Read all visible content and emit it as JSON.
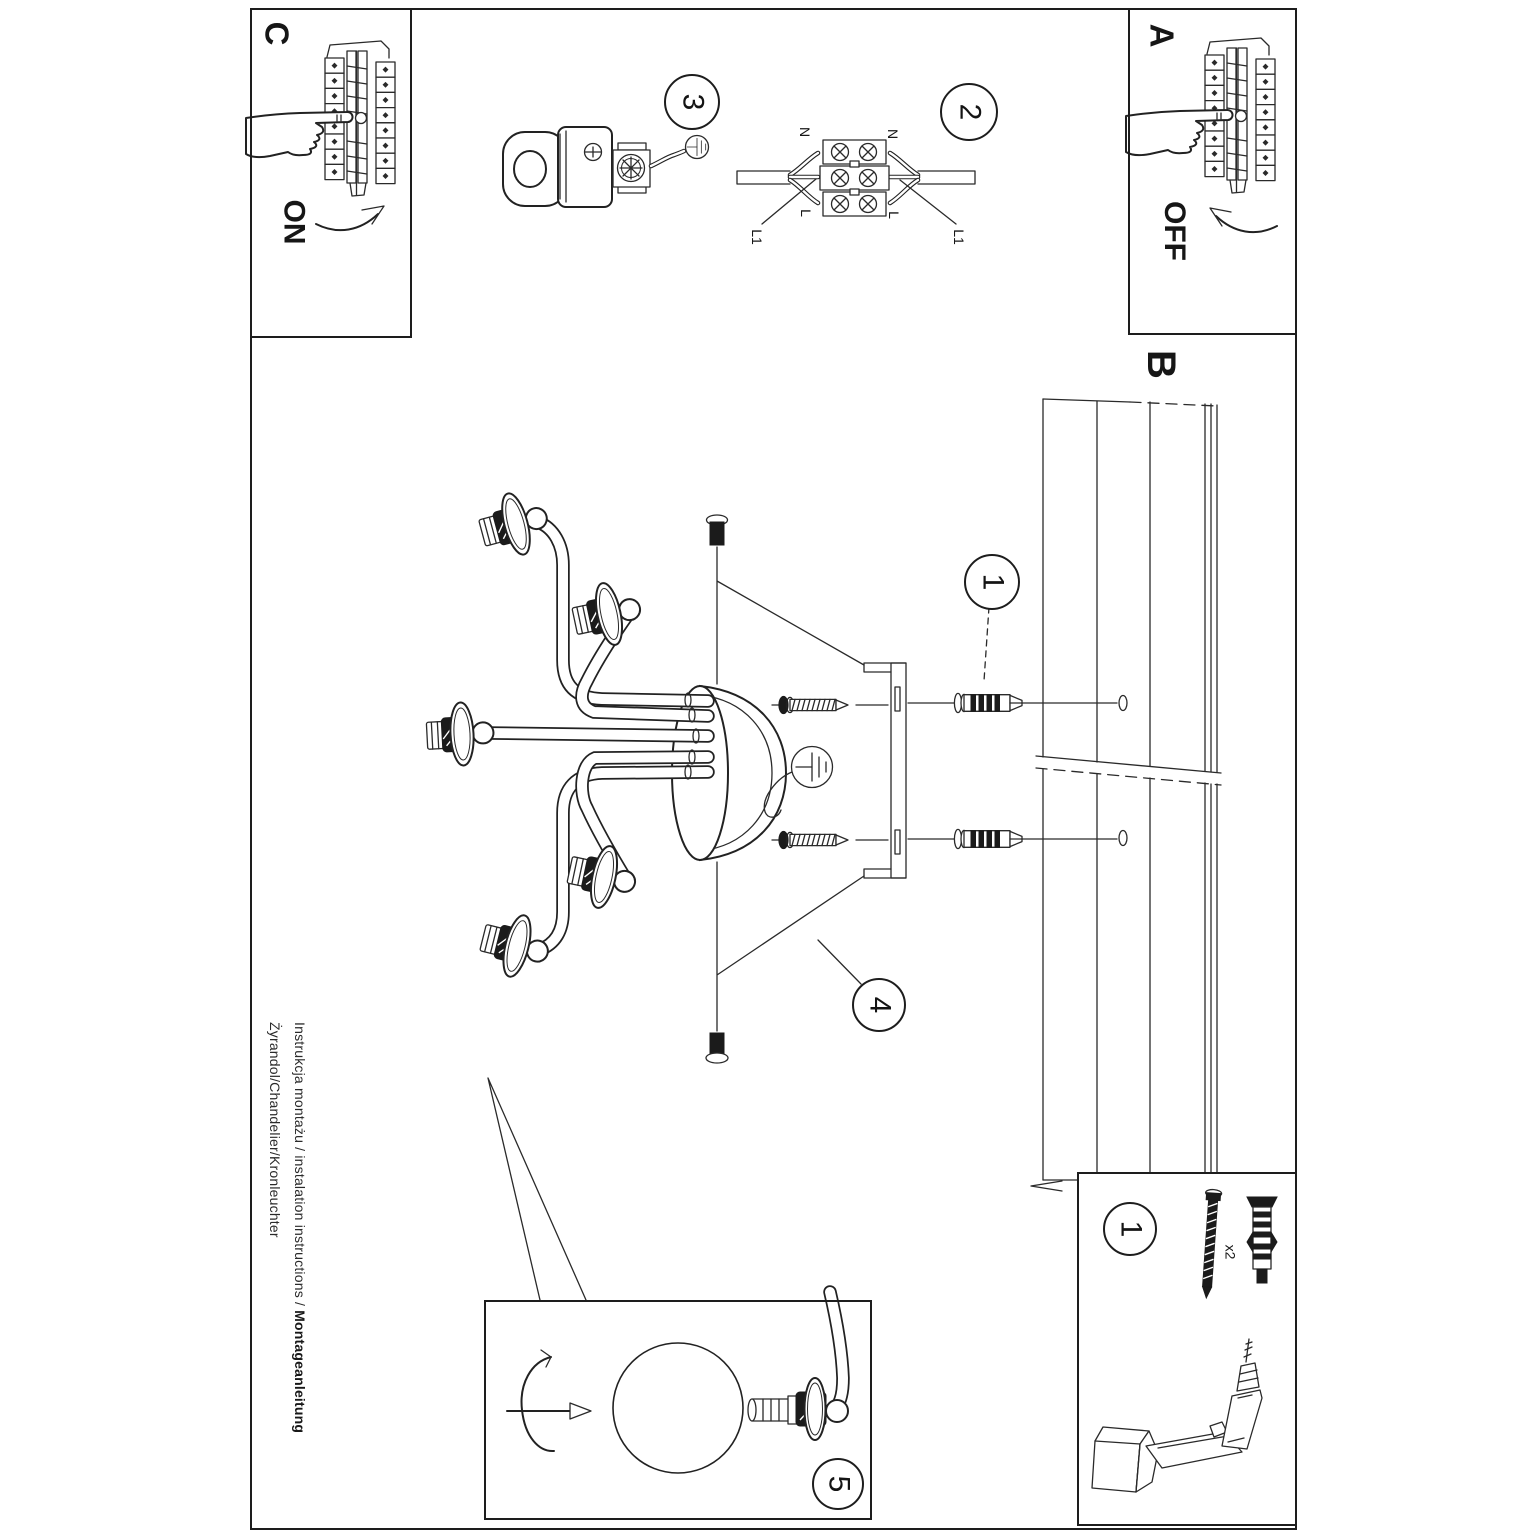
{
  "colors": {
    "paper": "#ffffff",
    "ink": "#1d1d1d"
  },
  "steps": {
    "a": "A",
    "b": "B",
    "c": "C"
  },
  "switch": {
    "on": "ON",
    "off": "OFF"
  },
  "callouts": {
    "n1": "1",
    "n2": "2",
    "n3": "3",
    "n4": "4",
    "n5": "5"
  },
  "wiring": {
    "neutral": "N",
    "live": "L",
    "l1": "L1"
  },
  "parts": {
    "anchor_qty": "x2"
  },
  "footer": {
    "line1_regular": "Instrukcja montażu / instalation instructions / ",
    "line1_bold": "Montageanleitung",
    "line2": "Żyrandol/Chandelier/Kronleuchter"
  }
}
